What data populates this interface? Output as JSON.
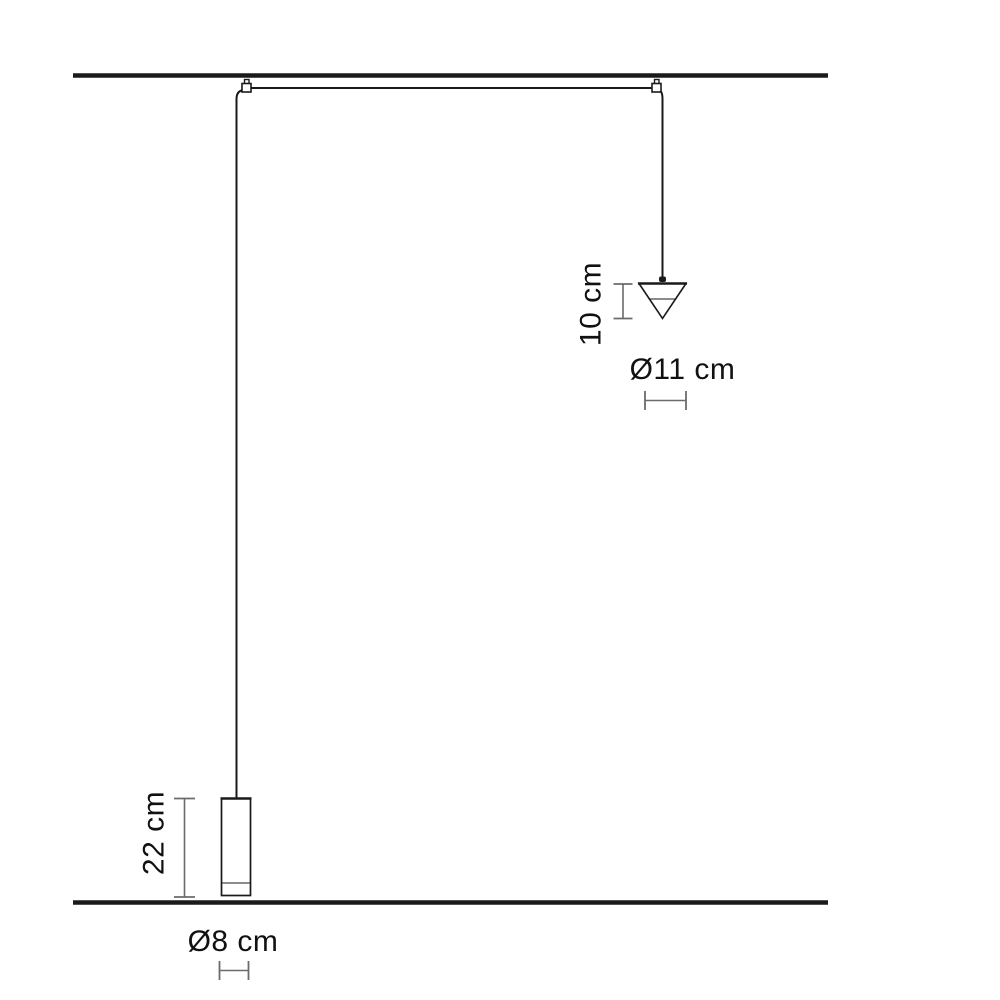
{
  "diagram": {
    "type": "product-dimension-drawing",
    "subject": "two-pendant ceiling lamp with cone shade and cylinder shade",
    "labels": {
      "cone_height": "10 cm",
      "cone_diameter": "Ø11 cm",
      "cylinder_height": "22 cm",
      "cylinder_diameter": "Ø8 cm"
    },
    "colors": {
      "line": "#1a1a1a",
      "dimension": "#6b6b6b",
      "text": "#111111",
      "background": "#ffffff"
    }
  }
}
